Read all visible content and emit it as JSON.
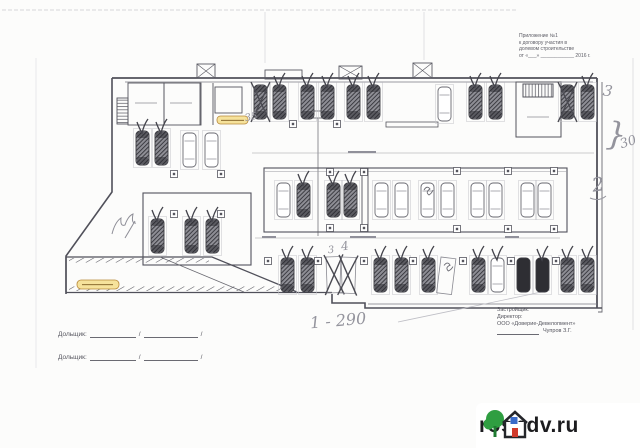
{
  "header_note": {
    "lines": [
      "Приложение №1",
      "к договору участия в",
      "долевом строительстве",
      "от «___» ____________ 2016 г."
    ]
  },
  "developer_block": {
    "role_label": "Застройщик:",
    "title_label": "Директор:",
    "company": "ООО «Доверие-Девелопмент»",
    "signatory": "Чупров З.Г."
  },
  "buyer_block": {
    "label1": "Дольщик:",
    "label2": "Дольщик:",
    "slash": "/"
  },
  "watermark": {
    "site": "rosndv.ru",
    "tree_color": "#2f9e41",
    "house_color": "#25262b",
    "window_color": "#3a6bc9",
    "door_color": "#d03a2b"
  },
  "plan": {
    "ink": "#50505a",
    "pencil": "#94949d",
    "pill_fill": "#f6e29b",
    "pill_border": "#b8893b",
    "stalls": [
      {
        "x": 253,
        "y": 84,
        "t": "hatched",
        "m": "x"
      },
      {
        "x": 272,
        "y": 84,
        "t": "hatched",
        "m": "v"
      },
      {
        "x": 300,
        "y": 84,
        "t": "hatched",
        "m": "v"
      },
      {
        "x": 320,
        "y": 84,
        "t": "hatched",
        "m": "v"
      },
      {
        "x": 346,
        "y": 84,
        "t": "hatched",
        "m": "v"
      },
      {
        "x": 366,
        "y": 84,
        "t": "hatched",
        "m": "v"
      },
      {
        "x": 437,
        "y": 86,
        "t": "outline",
        "m": ""
      },
      {
        "x": 468,
        "y": 84,
        "t": "hatched",
        "m": "v"
      },
      {
        "x": 488,
        "y": 84,
        "t": "hatched",
        "m": "v"
      },
      {
        "x": 560,
        "y": 84,
        "t": "hatched",
        "m": "x"
      },
      {
        "x": 580,
        "y": 84,
        "t": "hatched",
        "m": "v"
      },
      {
        "x": 135,
        "y": 130,
        "t": "hatched",
        "m": "v"
      },
      {
        "x": 154,
        "y": 130,
        "t": "hatched",
        "m": "v"
      },
      {
        "x": 182,
        "y": 132,
        "t": "outline",
        "m": ""
      },
      {
        "x": 204,
        "y": 132,
        "t": "outline",
        "m": ""
      },
      {
        "x": 150,
        "y": 218,
        "t": "hatched",
        "m": "v"
      },
      {
        "x": 184,
        "y": 218,
        "t": "hatched",
        "m": "v"
      },
      {
        "x": 205,
        "y": 218,
        "t": "hatched",
        "m": "v"
      },
      {
        "x": 276,
        "y": 182,
        "t": "outline",
        "m": ""
      },
      {
        "x": 296,
        "y": 182,
        "t": "hatched",
        "m": "v"
      },
      {
        "x": 326,
        "y": 182,
        "t": "hatched",
        "m": "v"
      },
      {
        "x": 343,
        "y": 182,
        "t": "hatched",
        "m": "v"
      },
      {
        "x": 374,
        "y": 182,
        "t": "outline",
        "m": ""
      },
      {
        "x": 394,
        "y": 182,
        "t": "outline",
        "m": ""
      },
      {
        "x": 420,
        "y": 182,
        "t": "outline",
        "m": "s"
      },
      {
        "x": 440,
        "y": 182,
        "t": "outline",
        "m": ""
      },
      {
        "x": 470,
        "y": 182,
        "t": "outline",
        "m": ""
      },
      {
        "x": 488,
        "y": 182,
        "t": "outline",
        "m": ""
      },
      {
        "x": 520,
        "y": 182,
        "t": "outline",
        "m": ""
      },
      {
        "x": 537,
        "y": 182,
        "t": "outline",
        "m": ""
      },
      {
        "x": 280,
        "y": 257,
        "t": "hatched",
        "m": "v"
      },
      {
        "x": 300,
        "y": 257,
        "t": "hatched",
        "m": "v"
      },
      {
        "x": 326,
        "y": 257,
        "t": "empty",
        "m": "x",
        "rot": -2
      },
      {
        "x": 341,
        "y": 257,
        "t": "empty",
        "m": "x",
        "rot": 2
      },
      {
        "x": 373,
        "y": 257,
        "t": "hatched",
        "m": "v"
      },
      {
        "x": 394,
        "y": 257,
        "t": "hatched",
        "m": "v"
      },
      {
        "x": 421,
        "y": 257,
        "t": "hatched",
        "m": "v"
      },
      {
        "x": 441,
        "y": 257,
        "t": "empty",
        "m": "s",
        "rot": 7
      },
      {
        "x": 471,
        "y": 257,
        "t": "hatched",
        "m": "v"
      },
      {
        "x": 490,
        "y": 257,
        "t": "outline",
        "m": "v"
      },
      {
        "x": 516,
        "y": 257,
        "t": "dark",
        "m": ""
      },
      {
        "x": 535,
        "y": 257,
        "t": "dark",
        "m": "v"
      },
      {
        "x": 560,
        "y": 257,
        "t": "hatched",
        "m": "v"
      },
      {
        "x": 580,
        "y": 257,
        "t": "hatched",
        "m": "v"
      }
    ],
    "columns": [
      {
        "x": 293,
        "y": 124
      },
      {
        "x": 337,
        "y": 124
      },
      {
        "x": 174,
        "y": 174
      },
      {
        "x": 221,
        "y": 174
      },
      {
        "x": 174,
        "y": 214
      },
      {
        "x": 221,
        "y": 214
      },
      {
        "x": 330,
        "y": 172
      },
      {
        "x": 364,
        "y": 172
      },
      {
        "x": 457,
        "y": 171
      },
      {
        "x": 508,
        "y": 171
      },
      {
        "x": 554,
        "y": 171
      },
      {
        "x": 330,
        "y": 228
      },
      {
        "x": 364,
        "y": 228
      },
      {
        "x": 457,
        "y": 229
      },
      {
        "x": 508,
        "y": 229
      },
      {
        "x": 554,
        "y": 229
      },
      {
        "x": 268,
        "y": 261
      },
      {
        "x": 318,
        "y": 261
      },
      {
        "x": 364,
        "y": 261
      },
      {
        "x": 413,
        "y": 261
      },
      {
        "x": 463,
        "y": 261
      },
      {
        "x": 511,
        "y": 261
      },
      {
        "x": 556,
        "y": 261
      }
    ],
    "annotations": [
      {
        "text": "35",
        "x": 245,
        "y": 113,
        "size": 10,
        "rot": -12
      },
      {
        "text": "3",
        "x": 603,
        "y": 84,
        "size": 15,
        "rot": 8
      },
      {
        "text": "}",
        "x": 606,
        "y": 118,
        "size": 32,
        "rot": 4
      },
      {
        "text": "30",
        "x": 620,
        "y": 136,
        "size": 13,
        "rot": -18
      },
      {
        "text": "2",
        "x": 592,
        "y": 176,
        "size": 19,
        "rot": -8
      },
      {
        "text": "3",
        "x": 328,
        "y": 246,
        "size": 10,
        "rot": -5
      },
      {
        "text": "4",
        "x": 341,
        "y": 240,
        "size": 12,
        "rot": -8
      },
      {
        "text": "1 - 290",
        "x": 310,
        "y": 313,
        "size": 16,
        "rot": -5
      }
    ]
  }
}
